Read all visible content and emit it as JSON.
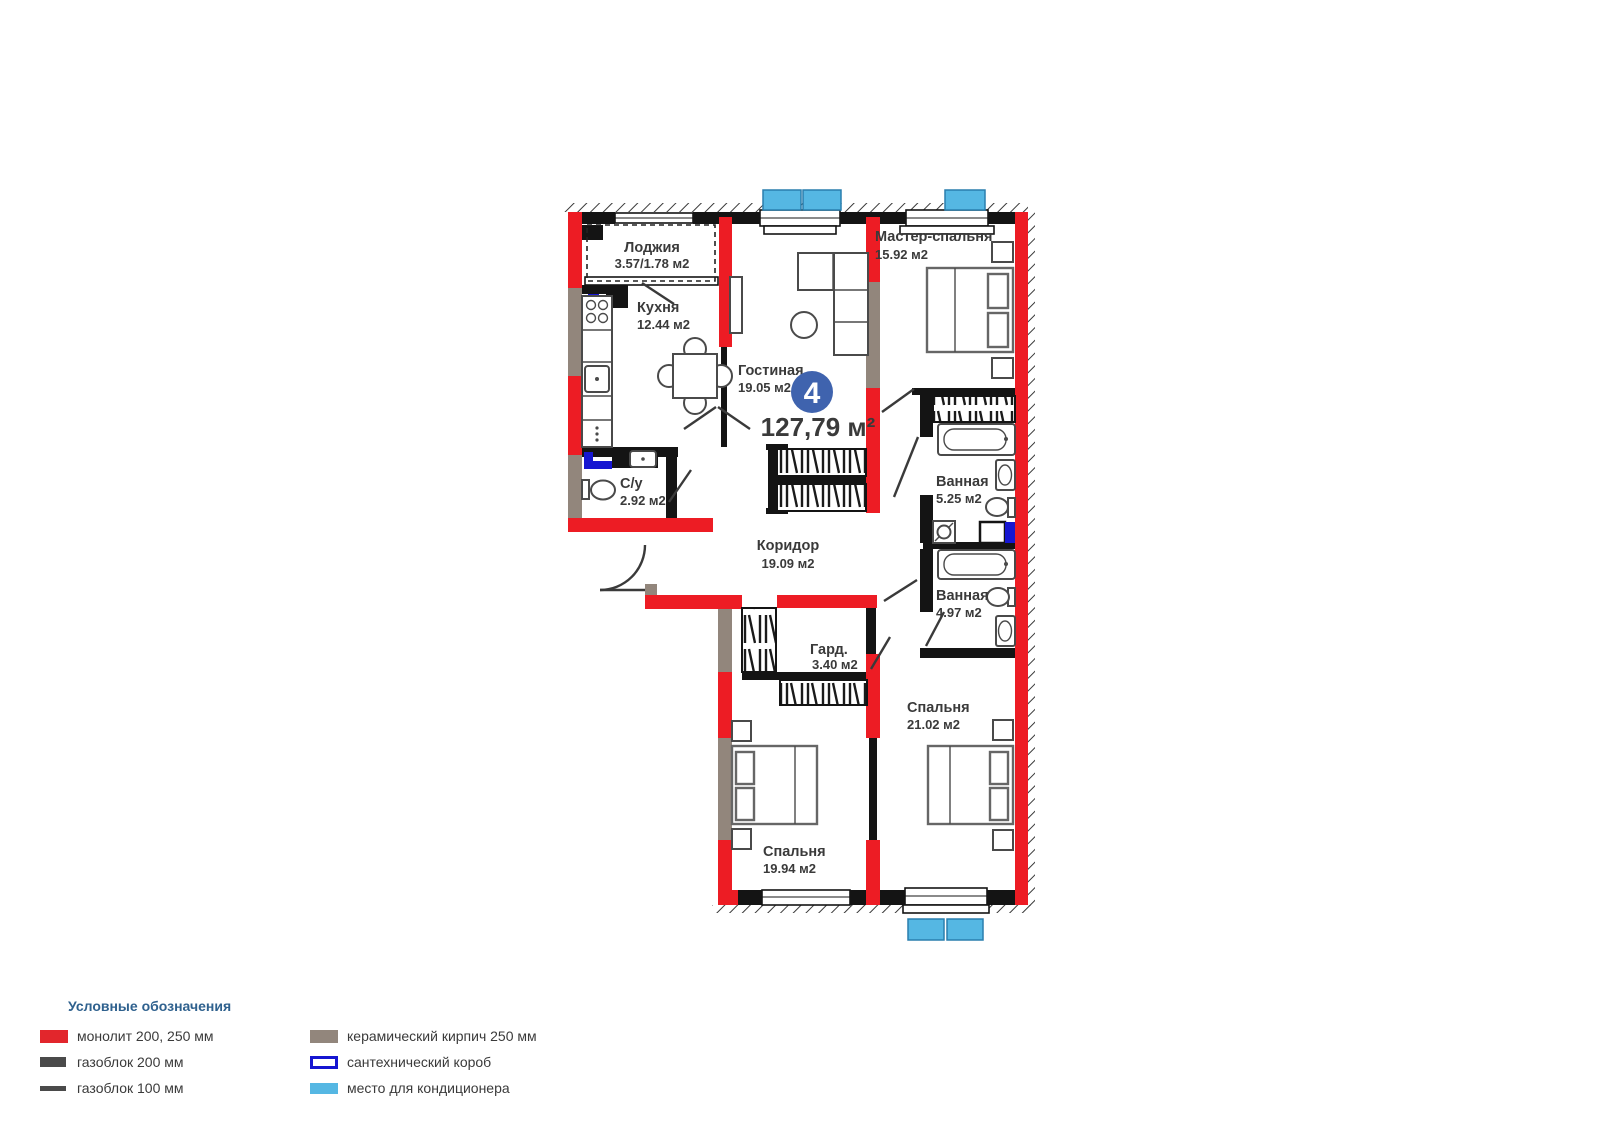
{
  "plan": {
    "unit_number": "4",
    "total_area": "127,79 м²",
    "rooms": [
      {
        "name": "Лоджия",
        "area_label": "3.57/1.78 м2"
      },
      {
        "name": "Кухня",
        "area_label": "12.44 м2"
      },
      {
        "name": "Гостиная",
        "area_label": "19.05 м2"
      },
      {
        "name": "Мастер-спальня",
        "area_label": "15.92 м2"
      },
      {
        "name": "Ванная",
        "area_label": "5.25 м2"
      },
      {
        "name": "Ванная",
        "area_label": "4.97 м2"
      },
      {
        "name": "С/у",
        "area_label": "2.92 м2"
      },
      {
        "name": "Коридор",
        "area_label": "19.09 м2"
      },
      {
        "name": "Гард.",
        "area_label": "3.40 м2"
      },
      {
        "name": "Спальня",
        "area_label": "21.02 м2"
      },
      {
        "name": "Спальня",
        "area_label": "19.94 м2"
      }
    ]
  },
  "legend": {
    "title": "Условные обозначения",
    "items": [
      {
        "label": "монолит 200, 250 мм",
        "swatch": "monolith"
      },
      {
        "label": "газоблок 200 мм",
        "swatch": "gasblock-200"
      },
      {
        "label": "газоблок 100 мм",
        "swatch": "gasblock-100"
      },
      {
        "label": "керамический кирпич 250 мм",
        "swatch": "ceramic-brick"
      },
      {
        "label": "сантехнический короб",
        "swatch": "plumbing-box"
      },
      {
        "label": "место для кондиционера",
        "swatch": "ac-place"
      }
    ]
  },
  "colors": {
    "monolith_red": "#ed1c24",
    "gasblock_dark": "#4a4a4a",
    "ceramic_brick": "#92867c",
    "plumbing_blue": "#1616d1",
    "ac_blue": "#55b7e3",
    "badge_blue": "#3f63ae",
    "legend_title_blue": "#2f618e",
    "label_text": "#3a3a3a"
  }
}
